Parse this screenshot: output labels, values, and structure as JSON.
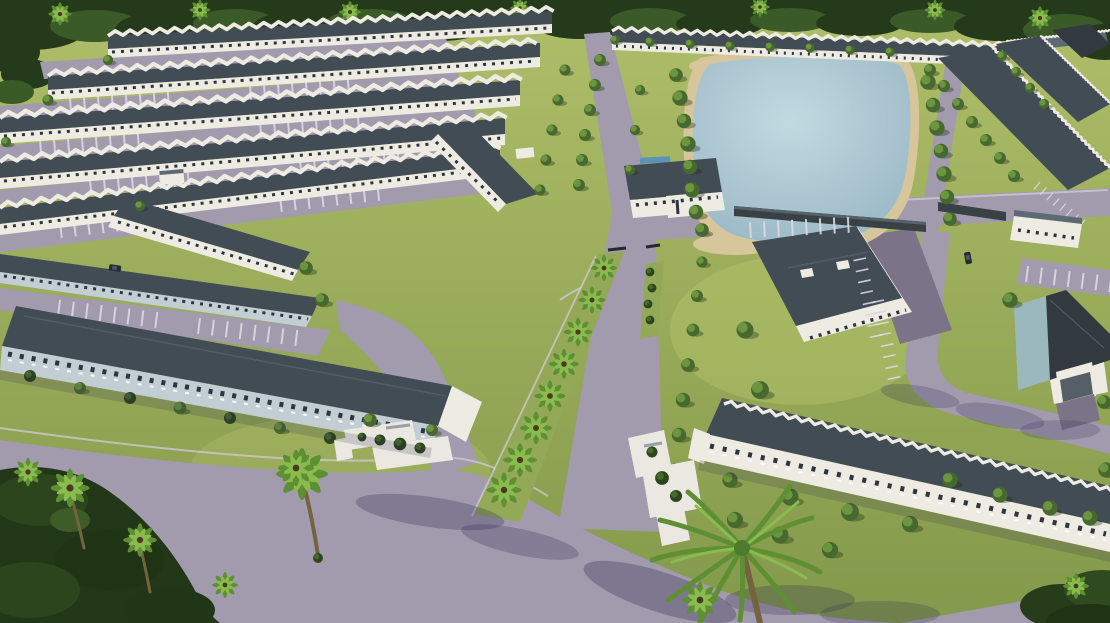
{
  "scene": {
    "type": "3d-aerial-architectural-rendering",
    "subject": "Master-planned townhome rental community",
    "details": "Oblique aerial view: parallel rows of two-story townhomes with charcoal shingle roofs and white or blue-gray facades, a large amenity lake with sand shoreline ringed by trees, a gated palm-lined entrance boulevard with landscaped median, single-story clubhouse buildings, white entry monument signs with planters, surface parking with striped stalls, lavender-gray asphalt roads, a dense tropical tree line on the horizon and large foreground palms",
    "features": [
      "townhome-rows",
      "amenity-lake",
      "sand-shoreline",
      "entrance-boulevard",
      "entry-gates",
      "median-island",
      "palm-median",
      "clubhouse",
      "lakeside-clubhouse",
      "monument-signs",
      "parking-stalls",
      "mail-kiosk-garages",
      "perimeter-roads",
      "forest-treeline",
      "foreground-palms",
      "cars"
    ]
  },
  "colors": {
    "grass_top": "#afbe69",
    "grass_bottom": "#83994b",
    "grass_mid": "#93a957",
    "grass_light": "#bac76f",
    "forest": "#243a1b",
    "forest_light": "#3a5a28",
    "tree": "#47682f",
    "tree_light": "#6b953e",
    "tree_dark": "#2b451d",
    "palm": "#5e8f33",
    "palm_light": "#8abb4e",
    "road": "#a29aad",
    "road_light": "#b0a8bb",
    "road_dark": "#7b7489",
    "sidewalk": "#d0cad7",
    "roof": "#424c55",
    "roof_light": "#5d6974",
    "roof_dark": "#32393f",
    "wall_white": "#edebe2",
    "wall_blue": "#c3cdd4",
    "wall_teal": "#9bb8bc",
    "window": "#2d353e",
    "water_edge": "#8fb2c1",
    "water_mid": "#a9c4cf",
    "water_center": "#c2d9e1",
    "sand": "#d7c69b",
    "monument": "#eae8e0",
    "shadow": "#2a2850",
    "stall": "#dcd8e4",
    "trunk": "#75623f",
    "car": "#262b33",
    "pool": "#5b93b8",
    "garage_wall": "#3a4145",
    "garage_door": "#565e66"
  }
}
